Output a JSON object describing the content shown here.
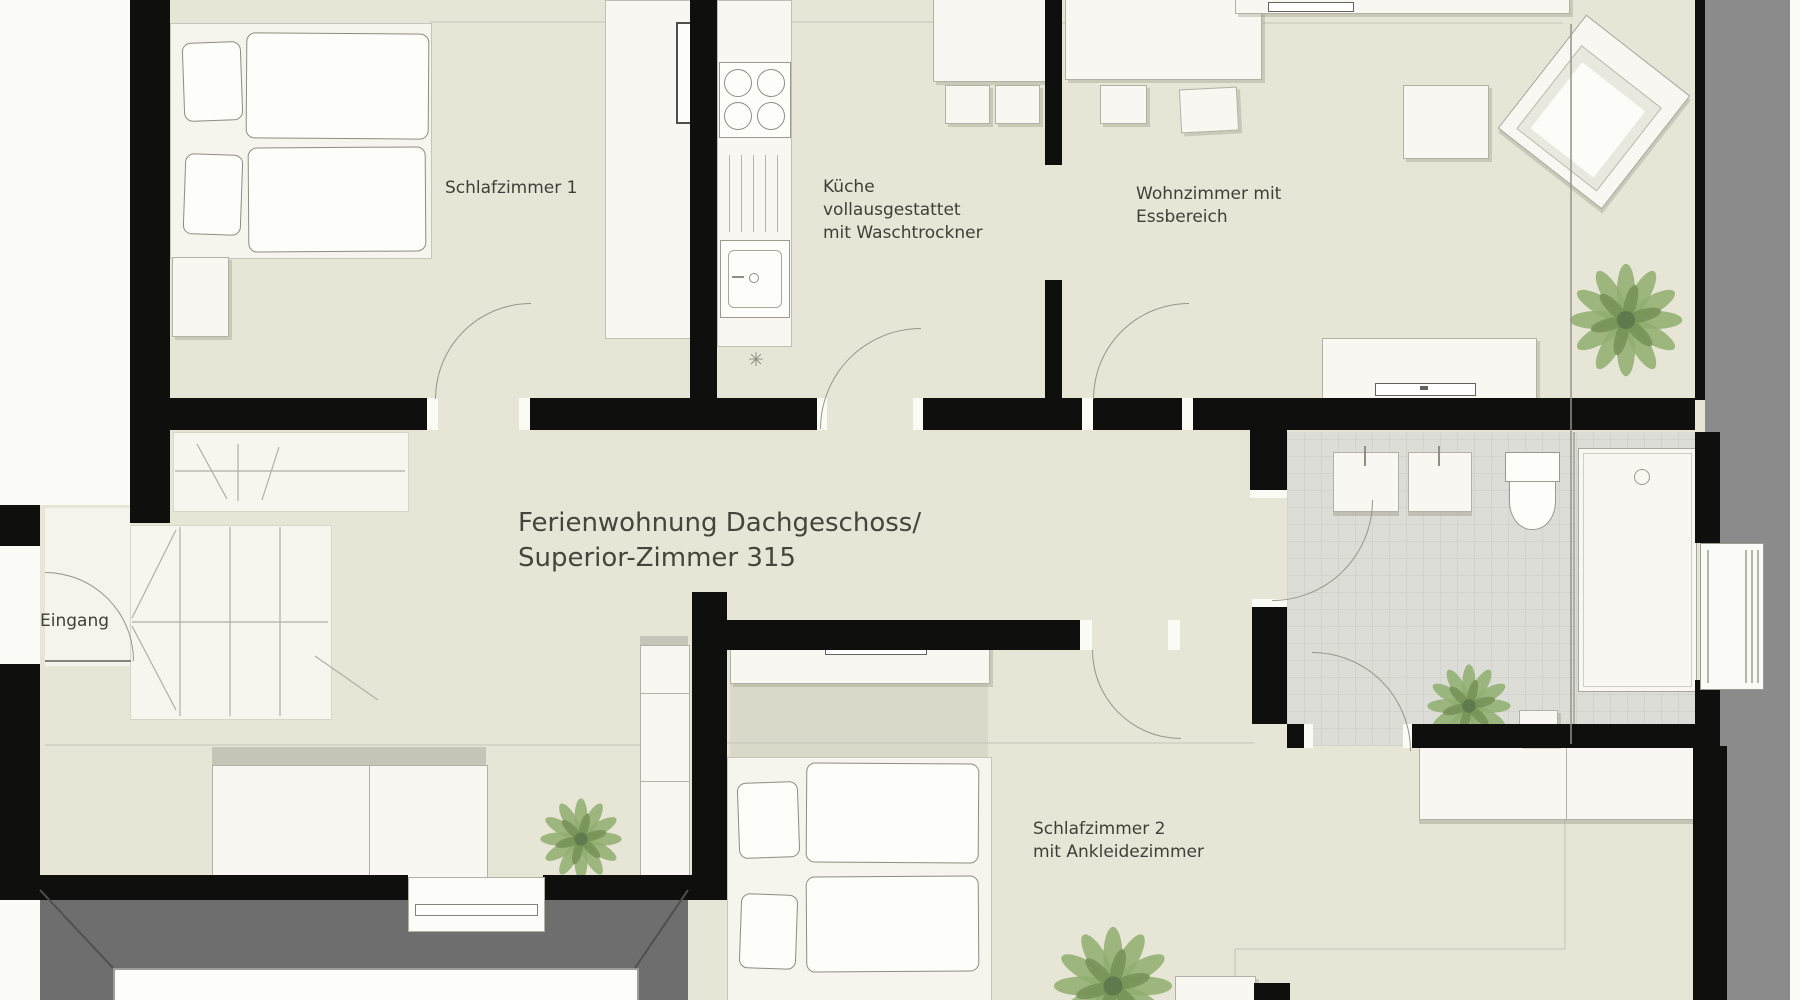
{
  "floorplan": {
    "title": {
      "line1": "Ferienwohnung Dachgeschoss/",
      "line2": "Superior-Zimmer 315"
    },
    "rooms": {
      "bedroom1": {
        "label": "Schlafzimmer 1"
      },
      "kitchen": {
        "label_line1": "Küche",
        "label_line2": "vollausgestattet",
        "label_line3": "mit Waschtrockner"
      },
      "living": {
        "label_line1": "Wohnzimmer mit",
        "label_line2": "Essbereich"
      },
      "entrance": {
        "label": "Eingang"
      },
      "bedroom2": {
        "label_line1": "Schlafzimmer 2",
        "label_line2": "mit Ankleidezimmer"
      }
    },
    "symbols": {
      "kitchen_light": "✳"
    },
    "colors": {
      "floor": "#e6e5d6",
      "wall": "#0f0f0e",
      "bath_tile": "#dcddd6",
      "terrace": "#6e6e6e",
      "roof_band": "#8b8b8b",
      "furniture": "#f8f7f1",
      "plant_green": "#87a05f"
    }
  }
}
